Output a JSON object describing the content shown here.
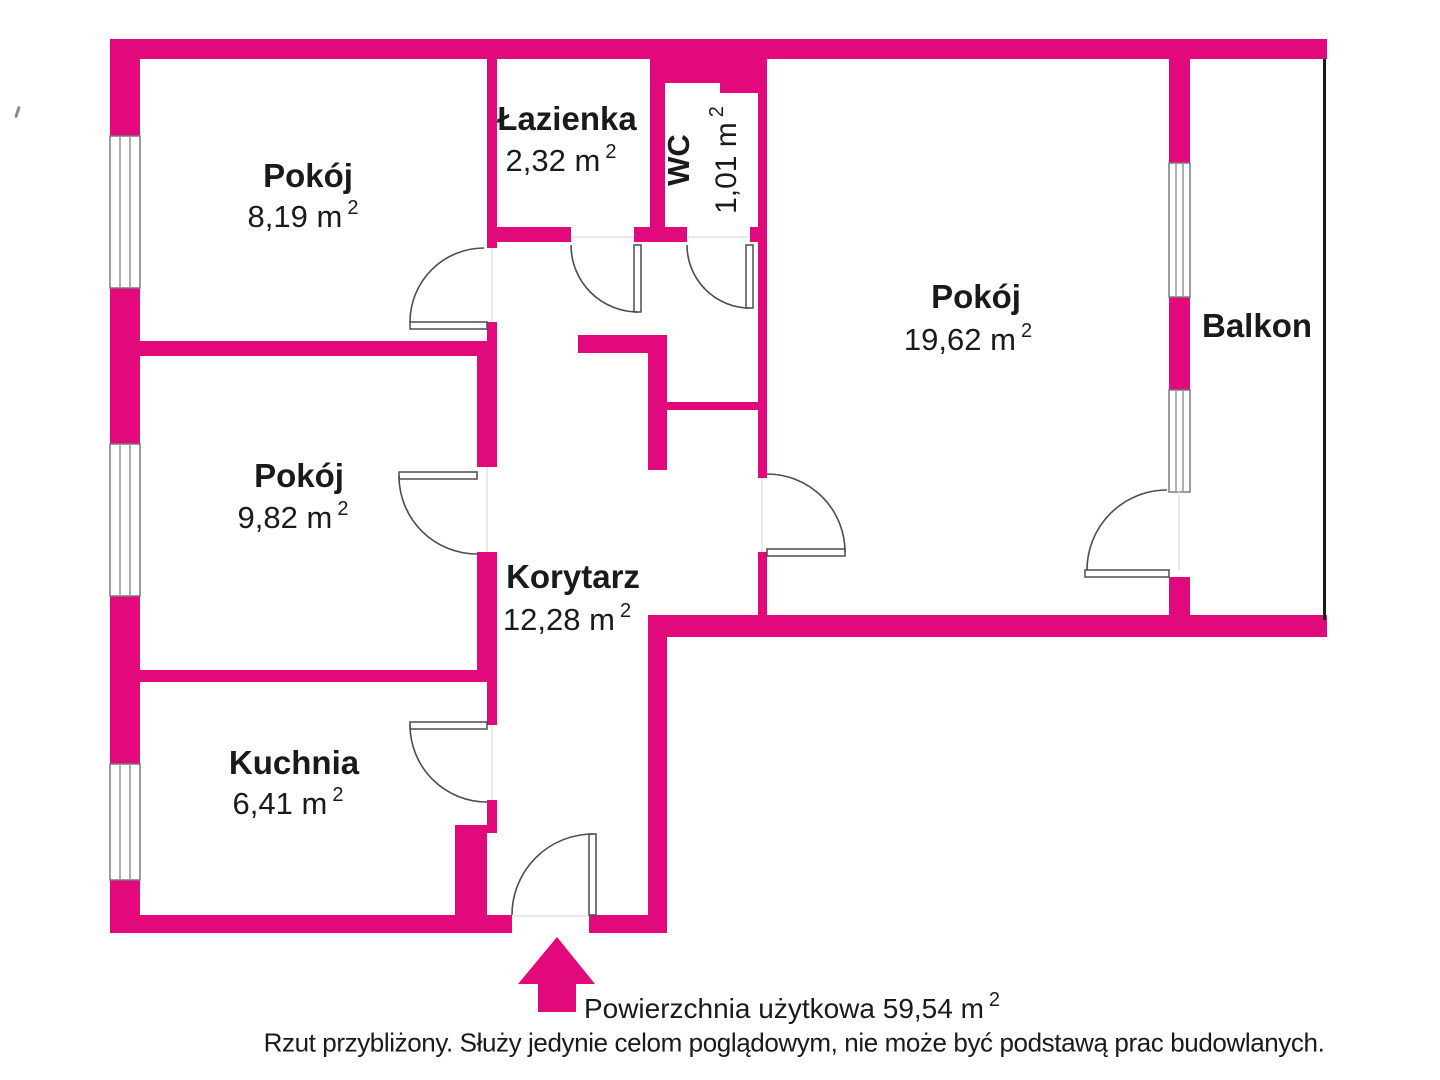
{
  "colors": {
    "wall": "#e2097c",
    "line": "#4d4d4d",
    "window_line": "#7a7a7a",
    "balcony_line": "#1a1a1a",
    "text": "#1a1a1a"
  },
  "rooms": [
    {
      "id": "room-top-left",
      "name": "Pokój",
      "area": "8,19 m",
      "sup": "2"
    },
    {
      "id": "bathroom",
      "name": "Łazienka",
      "area": "2,32 m",
      "sup": "2"
    },
    {
      "id": "wc",
      "name": "WC",
      "area": "1,01 m",
      "sup": "2"
    },
    {
      "id": "room-right",
      "name": "Pokój",
      "area": "19,62 m",
      "sup": "2"
    },
    {
      "id": "balcony",
      "name": "Balkon"
    },
    {
      "id": "room-mid-left",
      "name": "Pokój",
      "area": "9,82 m",
      "sup": "2"
    },
    {
      "id": "corridor",
      "name": "Korytarz",
      "area": "12,28 m",
      "sup": "2"
    },
    {
      "id": "kitchen",
      "name": "Kuchnia",
      "area": "6,41 m",
      "sup": "2"
    }
  ],
  "footer": {
    "total_area": "Powierzchnia użytkowa 59,54 m",
    "total_area_sup": "2",
    "disclaimer": "Rzut przybliżony. Służy jedynie celom poglądowym, nie może być podstawą prac budowlanych."
  }
}
